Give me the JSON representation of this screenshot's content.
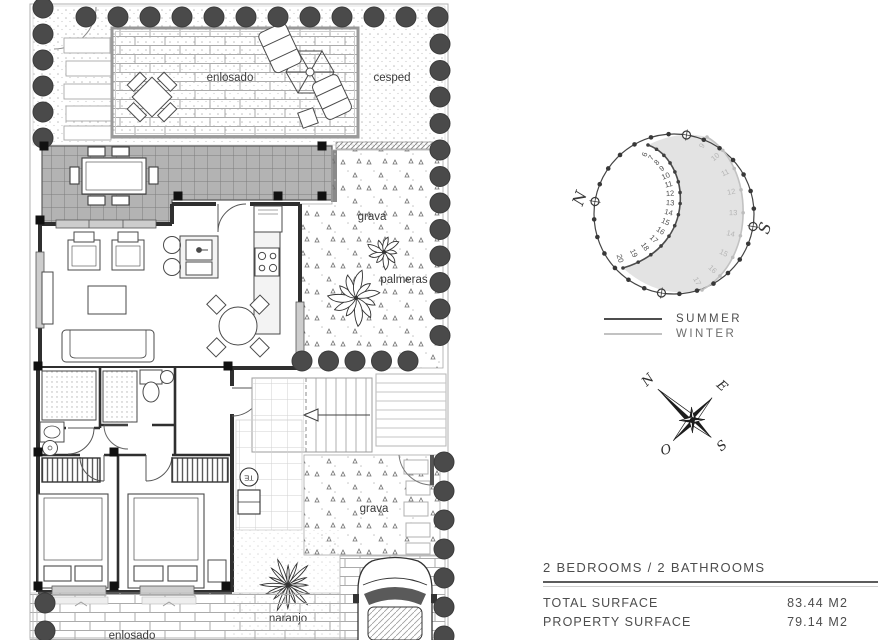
{
  "floor_plan": {
    "area_labels": {
      "enlosado_top": "enlosado",
      "cesped": "cesped",
      "grava_top": "grava",
      "palmeras": "palmeras",
      "grava_bottom": "grava",
      "naranjo": "naranjo",
      "enlosado_bottom": "enlosado"
    },
    "markers": {
      "utility": "TE"
    }
  },
  "sun_diagram": {
    "north_label": "N",
    "south_label": "S",
    "summer_hours": [
      6,
      7,
      8,
      9,
      10,
      11,
      12,
      13,
      14,
      15,
      16,
      17,
      18,
      19,
      20
    ],
    "winter_hours": [
      9,
      10,
      11,
      12,
      13,
      14,
      15,
      16,
      17
    ],
    "legend": [
      {
        "label": "SUMMER",
        "color": "#4d4d4d"
      },
      {
        "label": "WINTER",
        "color": "#c2c2c2"
      }
    ]
  },
  "compass": {
    "points": [
      "N",
      "E",
      "S",
      "O"
    ]
  },
  "info_panel": {
    "heading": "2 BEDROOMS / 2 BATHROOMS",
    "rows": [
      {
        "label": "TOTAL SURFACE",
        "value": "83.44 M2"
      },
      {
        "label": "PROPERTY SURFACE",
        "value": "79.14 M2"
      }
    ]
  },
  "colors": {
    "ink": "#3a3a3a",
    "wall": "#2f2f2f",
    "bush": "#4a4a4a",
    "shade": "#e3e3e3",
    "summer_line": "#4d4d4d",
    "winter_line": "#c2c2c2"
  }
}
